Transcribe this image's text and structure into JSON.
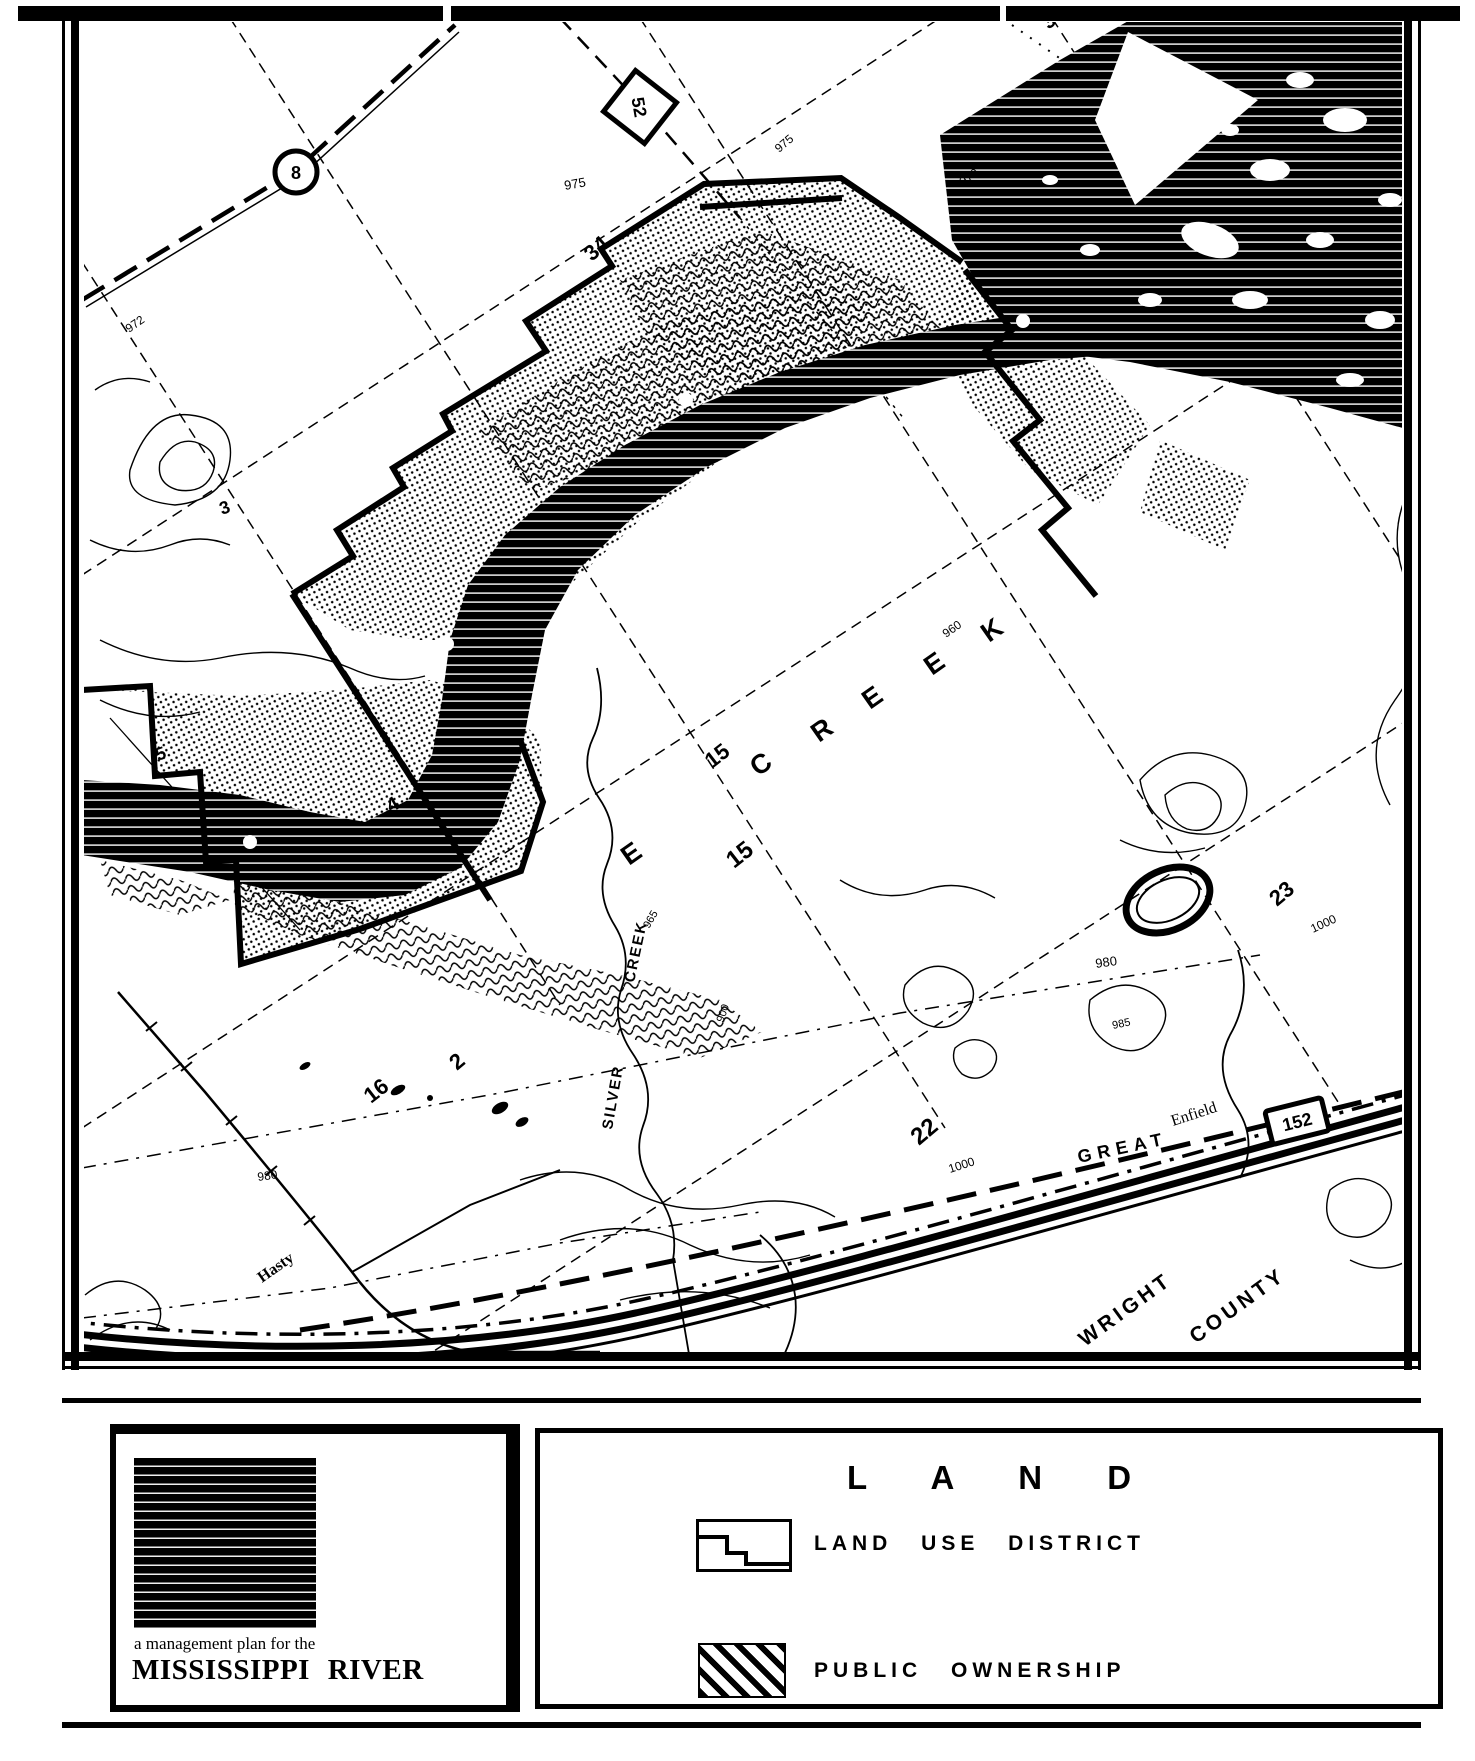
{
  "brand_panel": {
    "tagline": "a management plan for the",
    "title": "MISSISSIPPI RIVER"
  },
  "legend_panel": {
    "title": "L A N D",
    "items": [
      {
        "label": "LAND USE DISTRICT",
        "symbol": "district-boundary-outline"
      },
      {
        "label": "PUBLIC OWNERSHIP",
        "symbol": "diagonal-hatch"
      }
    ]
  },
  "map": {
    "description": "scanned black-and-white topographic land-use map, Mississippi River near Hasty, Wright County",
    "colors": {
      "ink": "#000000",
      "paper": "#ffffff"
    },
    "route_markers": [
      {
        "shape": "circle",
        "number": "8",
        "x": 296,
        "y": 172
      },
      {
        "shape": "diamond",
        "number": "52",
        "x": 640,
        "y": 107
      },
      {
        "shape": "rect",
        "number": "152",
        "x": 1297,
        "y": 1121
      }
    ],
    "labels": [
      {
        "t": "34",
        "x": 592,
        "y": 262,
        "r": -42,
        "s": 22,
        "w": 700
      },
      {
        "t": "35",
        "x": 1049,
        "y": 30,
        "r": -42,
        "s": 20,
        "w": 700
      },
      {
        "t": "975",
        "x": 565,
        "y": 190,
        "r": -10,
        "s": 13,
        "w": 400
      },
      {
        "t": "975",
        "x": 779,
        "y": 153,
        "r": -40,
        "s": 12,
        "w": 400
      },
      {
        "t": "970",
        "x": 963,
        "y": 186,
        "r": -35,
        "s": 12,
        "w": 400
      },
      {
        "t": "972",
        "x": 129,
        "y": 333,
        "r": -35,
        "s": 12,
        "w": 400
      },
      {
        "t": "3",
        "x": 222,
        "y": 515,
        "r": -20,
        "s": 18,
        "w": 700
      },
      {
        "t": "4",
        "x": 391,
        "y": 813,
        "r": -30,
        "s": 20,
        "w": 700
      },
      {
        "t": "5",
        "x": 158,
        "y": 761,
        "r": -20,
        "s": 18,
        "w": 700
      },
      {
        "t": "15",
        "x": 712,
        "y": 769,
        "r": -38,
        "s": 22,
        "w": 700
      },
      {
        "t": "15",
        "x": 734,
        "y": 869,
        "r": -38,
        "s": 24,
        "w": 700
      },
      {
        "t": "16",
        "x": 371,
        "y": 1104,
        "r": -38,
        "s": 22,
        "w": 700
      },
      {
        "t": "2",
        "x": 457,
        "y": 1071,
        "r": -40,
        "s": 22,
        "w": 700
      },
      {
        "t": "22",
        "x": 919,
        "y": 1146,
        "r": -40,
        "s": 24,
        "w": 700
      },
      {
        "t": "23",
        "x": 1277,
        "y": 907,
        "r": -40,
        "s": 22,
        "w": 700
      },
      {
        "t": "1000",
        "x": 950,
        "y": 1173,
        "r": -18,
        "s": 12,
        "w": 400
      },
      {
        "t": "1000",
        "x": 1313,
        "y": 933,
        "r": -25,
        "s": 12,
        "w": 400
      },
      {
        "t": "980",
        "x": 258,
        "y": 1181,
        "r": -8,
        "s": 12,
        "w": 400
      },
      {
        "t": "980",
        "x": 1096,
        "y": 968,
        "r": -8,
        "s": 13,
        "w": 400
      },
      {
        "t": "985",
        "x": 1113,
        "y": 1029,
        "r": -12,
        "s": 11,
        "w": 400
      },
      {
        "t": "965",
        "x": 649,
        "y": 929,
        "r": -60,
        "s": 11,
        "w": 400
      },
      {
        "t": "900",
        "x": 723,
        "y": 1023,
        "r": -70,
        "s": 11,
        "w": 400
      },
      {
        "t": "960",
        "x": 946,
        "y": 638,
        "r": -35,
        "s": 12,
        "w": 400
      },
      {
        "t": "E",
        "x": 629,
        "y": 866,
        "r": -35,
        "s": 27,
        "w": 700
      },
      {
        "t": "C",
        "x": 758,
        "y": 777,
        "r": -35,
        "s": 27,
        "w": 700
      },
      {
        "t": "R",
        "x": 819,
        "y": 743,
        "r": -35,
        "s": 27,
        "w": 700
      },
      {
        "t": "E",
        "x": 870,
        "y": 710,
        "r": -35,
        "s": 27,
        "w": 700
      },
      {
        "t": "E",
        "x": 932,
        "y": 676,
        "r": -35,
        "s": 27,
        "w": 700
      },
      {
        "t": "K",
        "x": 989,
        "y": 643,
        "r": -35,
        "s": 27,
        "w": 700
      },
      {
        "t": "SILVER",
        "x": 612,
        "y": 1130,
        "r": -80,
        "s": 15,
        "w": 700,
        "ls": 2
      },
      {
        "t": "CREEK",
        "x": 634,
        "y": 983,
        "r": -78,
        "s": 15,
        "w": 700,
        "ls": 2
      },
      {
        "t": "Hasty",
        "x": 262,
        "y": 1283,
        "r": -35,
        "s": 16,
        "w": 700,
        "f": "serif"
      },
      {
        "t": "GREAT",
        "x": 1079,
        "y": 1163,
        "r": -12,
        "s": 18,
        "w": 700,
        "ls": 6
      },
      {
        "t": "Enfield",
        "x": 1173,
        "y": 1126,
        "r": -18,
        "s": 16,
        "w": 400,
        "f": "serif"
      },
      {
        "t": "WRIGHT",
        "x": 1085,
        "y": 1347,
        "r": -36,
        "s": 21,
        "w": 700,
        "ls": 4
      },
      {
        "t": "COUNTY",
        "x": 1196,
        "y": 1344,
        "r": -36,
        "s": 21,
        "w": 700,
        "ls": 4
      }
    ]
  }
}
